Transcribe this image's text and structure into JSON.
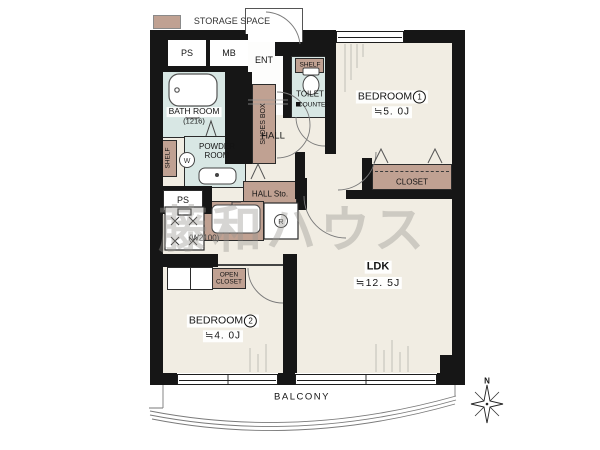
{
  "legend": {
    "storage_space": "STORAGE SPACE"
  },
  "watermark": "藤和ハウス",
  "colors": {
    "wall": "#161616",
    "storage_tan": "#c0a192",
    "wet_room_floor": "#d8e7e4",
    "room_floor": "#f1ede3"
  },
  "utility": {
    "ps_top": "PS",
    "mb": "MB",
    "ps_bottom": "PS"
  },
  "bath": {
    "name": "BATH ROOM",
    "size": "(1216)"
  },
  "ent": {
    "name": "ENT",
    "shoes_box": "SHOES BOX"
  },
  "toilet": {
    "shelf": "SHELF",
    "name": "TOILET",
    "counter": "COUNTER"
  },
  "powder": {
    "name": "POWDER ROOM",
    "shelf": "SHELF",
    "washer": "W"
  },
  "hall": {
    "name": "HALL",
    "storage": "HALL Sto."
  },
  "kitchen": {
    "width": "(W2100)",
    "fridge": "R"
  },
  "bedroom1": {
    "name": "BEDROOM",
    "number": "1",
    "size": "≒5. 0J",
    "closet": "CLOSET"
  },
  "bedroom2": {
    "name": "BEDROOM",
    "number": "2",
    "size": "≒4. 0J",
    "open_closet_line1": "OPEN",
    "open_closet_line2": "CLOSET"
  },
  "ldk": {
    "name": "LDK",
    "size": "≒12. 5J"
  },
  "balcony": {
    "name": "BALCONY"
  },
  "compass": {
    "north": "N"
  }
}
